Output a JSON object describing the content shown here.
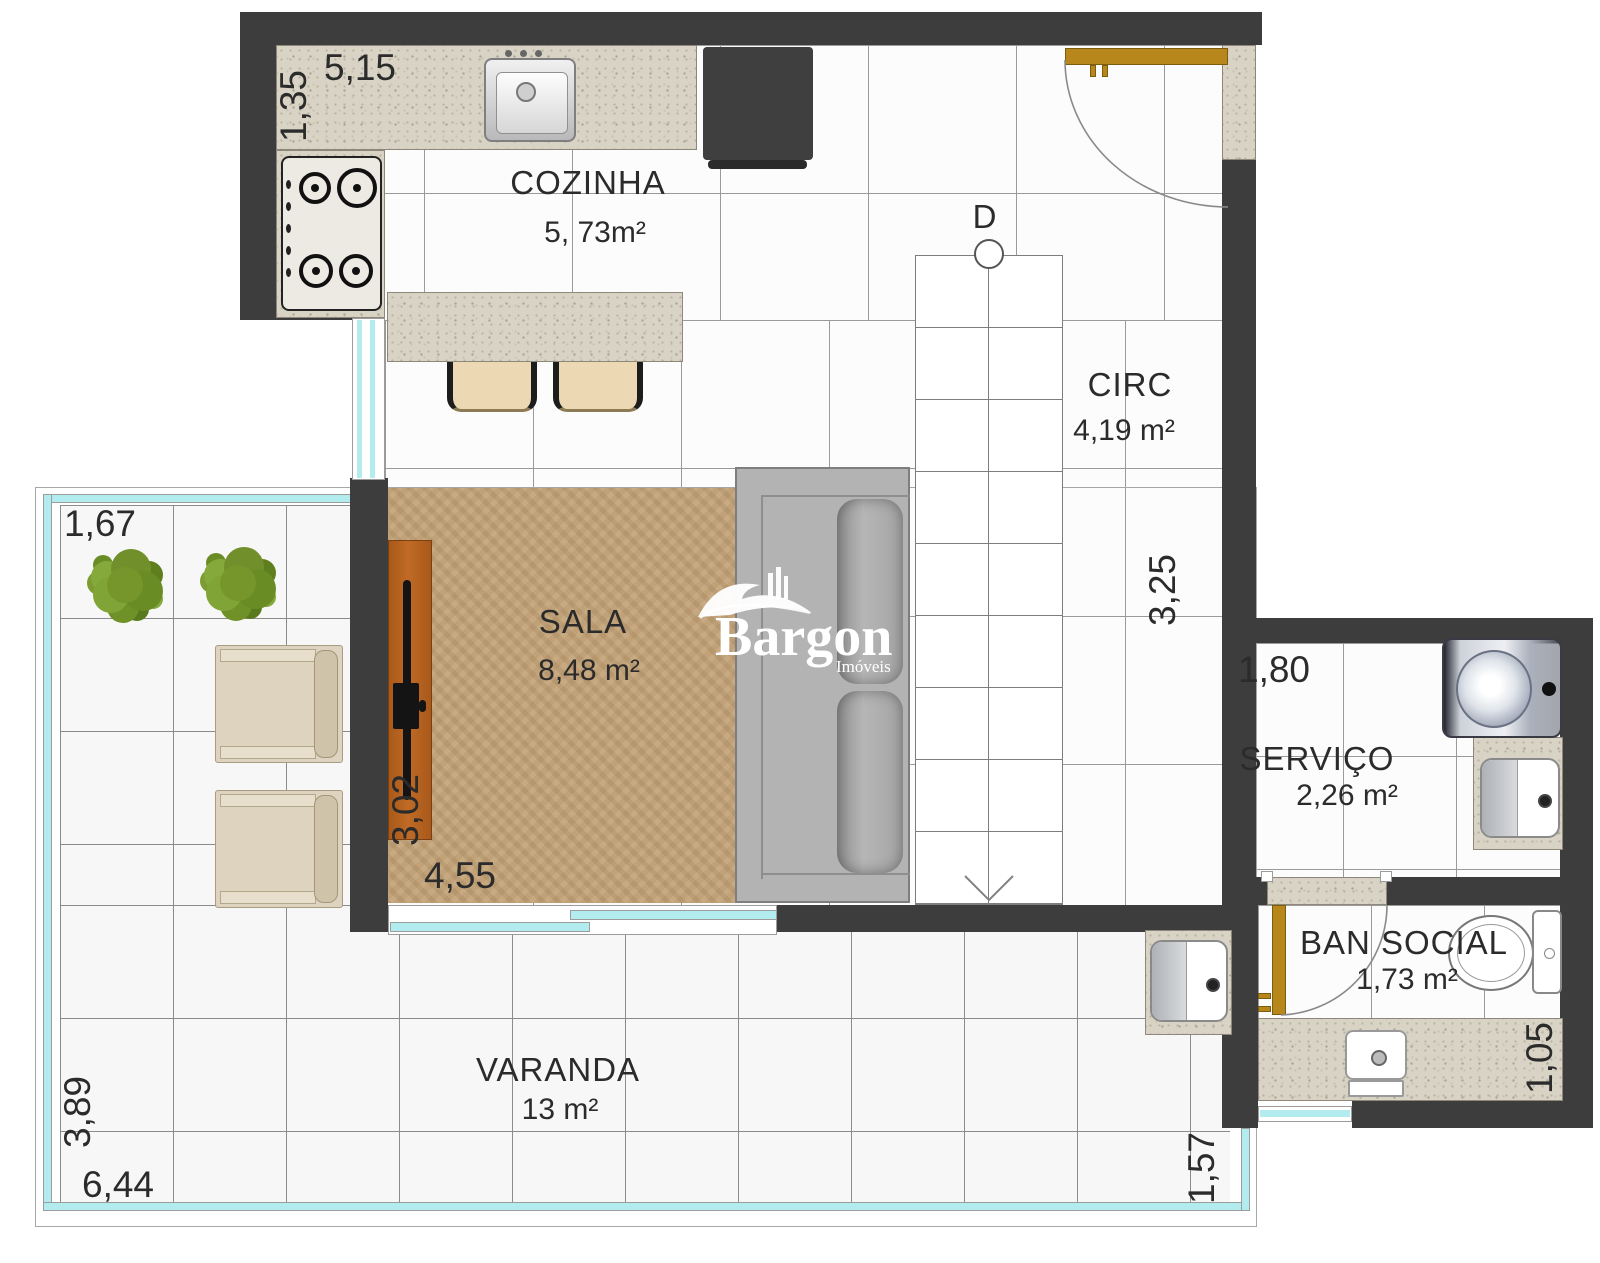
{
  "brand": {
    "name": "Bargon",
    "sub": "Imóveis"
  },
  "rooms": {
    "cozinha": {
      "name": "COZINHA",
      "area": "5, 73m²"
    },
    "circ": {
      "name": "CIRC",
      "area": "4,19 m²"
    },
    "sala": {
      "name": "SALA",
      "area": "8,48 m²"
    },
    "servico": {
      "name": "SERVIÇO",
      "area": "2,26 m²"
    },
    "ban_social": {
      "name": "BAN SOCIAL",
      "area": "1,73 m²"
    },
    "varanda": {
      "name": "VARANDA",
      "area": "13 m²"
    }
  },
  "dimensions": {
    "kitchen_top": "5,15",
    "kitchen_left": "1,35",
    "balcony_top": "1,67",
    "sala_left": "3,02",
    "sala_bottom": "4,55",
    "circ_right": "3,25",
    "servico_top": "1,80",
    "balcony_left": "3,89",
    "balcony_bottom": "6,44",
    "balcony_right": "1,57",
    "ban_social_right": "1,05"
  },
  "stairs": {
    "label": "D"
  },
  "colors": {
    "wall": "#3d3d3d",
    "glass": "#b2ecef",
    "door": "#b8871b",
    "granite": "#d8d3c4",
    "rug": "#c1a177",
    "wood": "#b05f1e",
    "plant": "#76962c",
    "text": "#2b2b2b"
  }
}
